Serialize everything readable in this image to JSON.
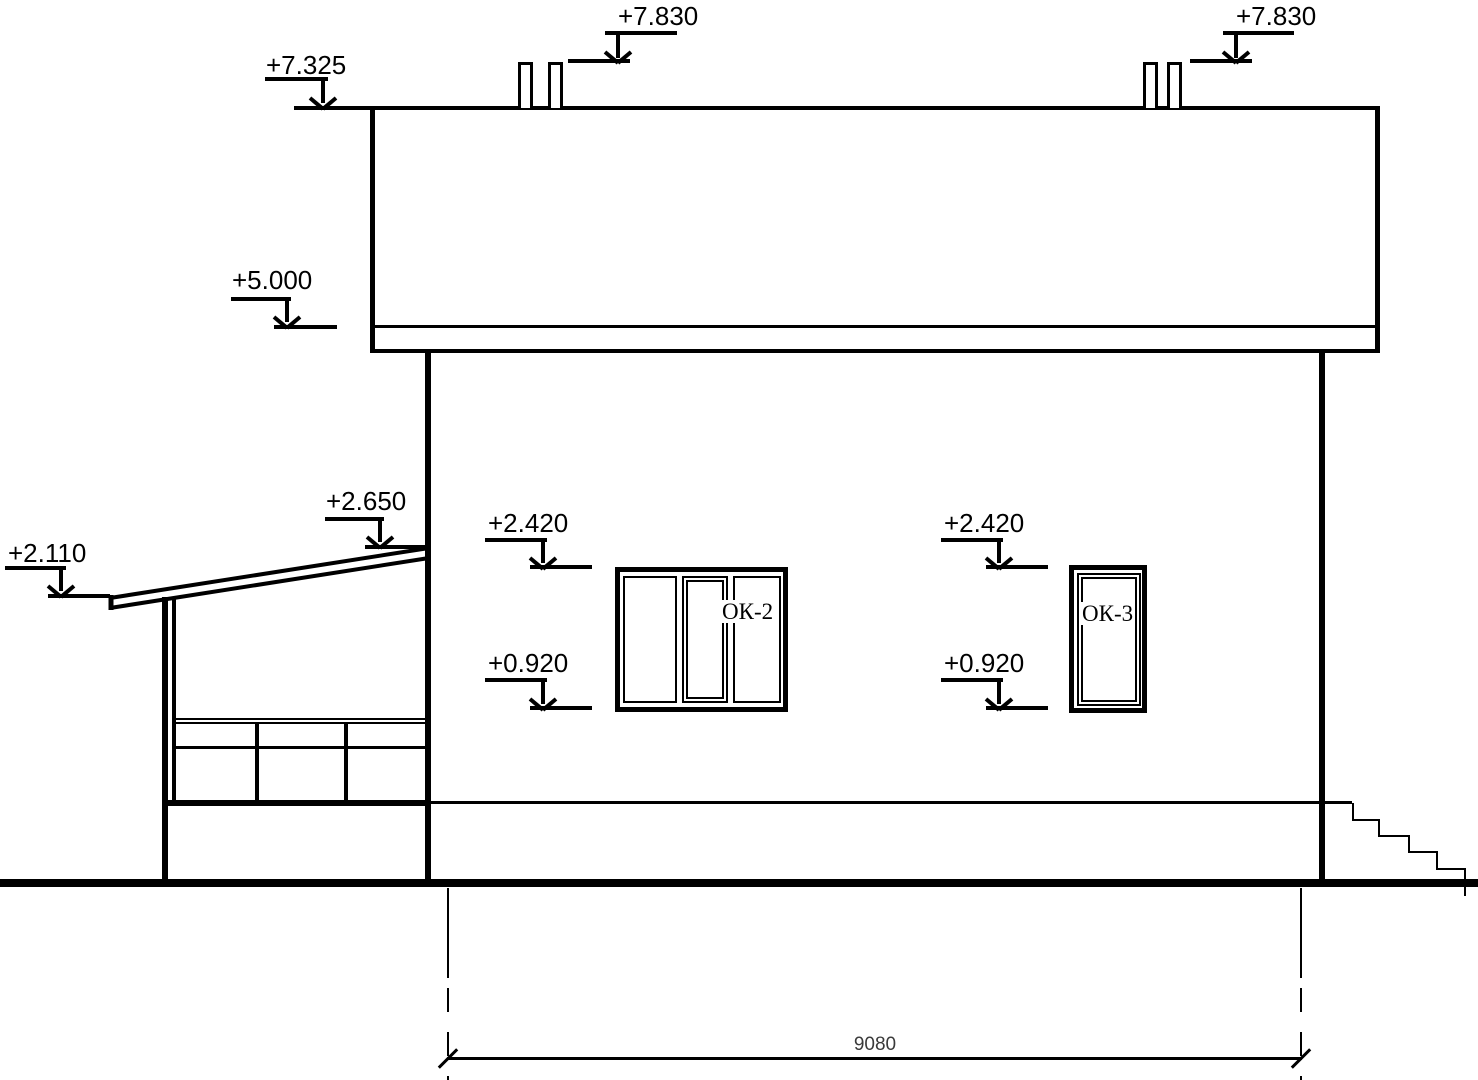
{
  "colors": {
    "ink": "#000000",
    "paper": "#ffffff",
    "dim_text": "#3a3a3a"
  },
  "elevation_marks": [
    {
      "label": "+7.830"
    },
    {
      "label": "+7.830"
    },
    {
      "label": "+7.325"
    },
    {
      "label": "+5.000"
    },
    {
      "label": "+2.650"
    },
    {
      "label": "+2.110"
    },
    {
      "label": "+2.420"
    },
    {
      "label": "+0.920"
    },
    {
      "label": "+2.420"
    },
    {
      "label": "+0.920"
    }
  ],
  "windows": [
    {
      "label": "ОК-2"
    },
    {
      "label": "ОК-3"
    }
  ],
  "dimension": {
    "overall_width": "9080"
  }
}
